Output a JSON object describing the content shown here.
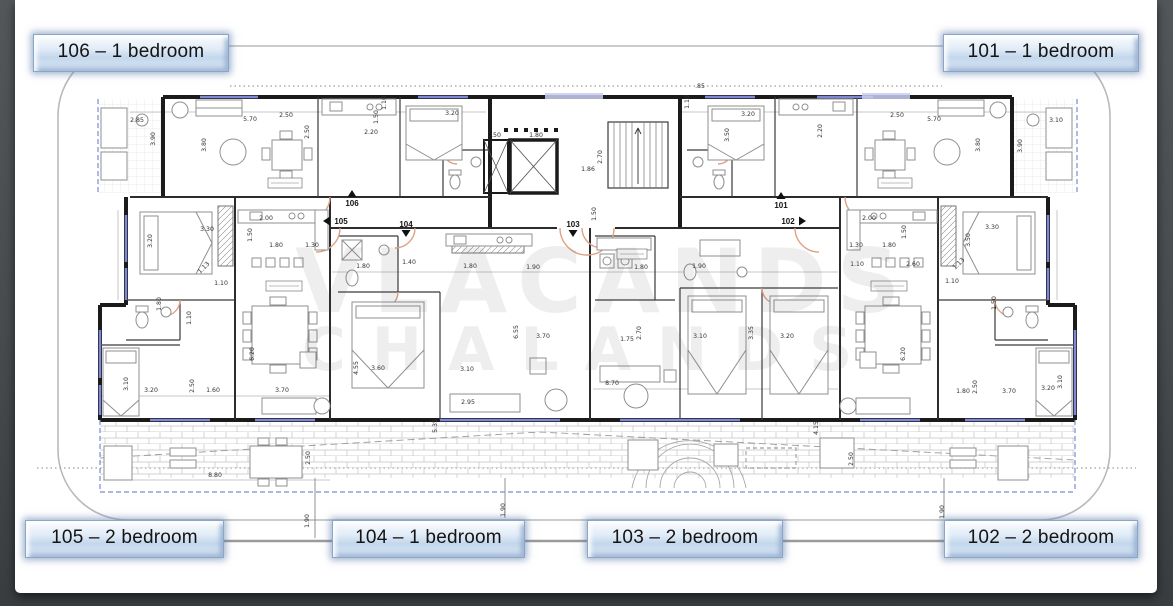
{
  "page": {
    "background_dark": "#474b4e",
    "sheet_color": "#ffffff"
  },
  "labels": [
    {
      "unit": "106",
      "text": "106 – 1 bedroom",
      "position": "top-left"
    },
    {
      "unit": "101",
      "text": "101 – 1 bedroom",
      "position": "top-right"
    },
    {
      "unit": "105",
      "text": "105 – 2 bedroom",
      "position": "bottom-left"
    },
    {
      "unit": "104",
      "text": "104 – 1 bedroom",
      "position": "bottom-center-left"
    },
    {
      "unit": "103",
      "text": "103 – 2 bedroom",
      "position": "bottom-center-right"
    },
    {
      "unit": "102",
      "text": "102 – 2 bedroom",
      "position": "bottom-right"
    }
  ],
  "watermark": {
    "line1_approx": "VLACANDS",
    "line2_approx": "CHALANDS"
  },
  "plan": {
    "unit_markers": [
      {
        "text": "106",
        "x": 352,
        "y": 206,
        "arrow": "up"
      },
      {
        "text": "105",
        "x": 341,
        "y": 224,
        "arrow": "left"
      },
      {
        "text": "104",
        "x": 406,
        "y": 227,
        "arrow": "down"
      },
      {
        "text": "103",
        "x": 573,
        "y": 227,
        "arrow": "down"
      },
      {
        "text": "101",
        "x": 781,
        "y": 208,
        "arrow": "up"
      },
      {
        "text": "102",
        "x": 788,
        "y": 224,
        "arrow": "right"
      }
    ],
    "dimensions": [
      [
        137,
        122,
        "2.85",
        0
      ],
      [
        250,
        121,
        "5.70",
        0
      ],
      [
        286,
        117,
        "2.50",
        0
      ],
      [
        371,
        134,
        "2.20",
        0
      ],
      [
        452,
        115,
        "3.20",
        0
      ],
      [
        155,
        139,
        "3.90",
        90
      ],
      [
        206,
        145,
        "3.80",
        90
      ],
      [
        309,
        132,
        "2.50",
        90
      ],
      [
        378,
        117,
        "1.50",
        90
      ],
      [
        386,
        103,
        "1.10",
        90
      ],
      [
        700,
        88,
        ".85",
        0
      ],
      [
        689,
        102,
        "1.10",
        90
      ],
      [
        536,
        137,
        "1.80",
        0
      ],
      [
        496,
        137,
        ".50",
        0
      ],
      [
        602,
        157,
        "2.70",
        90
      ],
      [
        588,
        171,
        "1.86",
        0
      ],
      [
        748,
        116,
        "3.20",
        0
      ],
      [
        897,
        117,
        "2.50",
        0
      ],
      [
        934,
        121,
        "5.70",
        0
      ],
      [
        1056,
        122,
        "3.10",
        0
      ],
      [
        729,
        135,
        "3.50",
        90
      ],
      [
        822,
        131,
        "2.20",
        90
      ],
      [
        980,
        145,
        "3.80",
        90
      ],
      [
        1022,
        146,
        "3.90",
        90
      ],
      [
        207,
        231,
        "3.30",
        0
      ],
      [
        152,
        241,
        "3.20",
        90
      ],
      [
        266,
        220,
        "2.00",
        0
      ],
      [
        252,
        235,
        "1.50",
        90
      ],
      [
        276,
        247,
        "1.80",
        0
      ],
      [
        312,
        247,
        "1.30",
        0
      ],
      [
        205,
        269,
        "1.13",
        45
      ],
      [
        221,
        285,
        "1.10",
        0
      ],
      [
        161,
        304,
        "1.80",
        90
      ],
      [
        191,
        318,
        "1.10",
        90
      ],
      [
        363,
        268,
        "1.80",
        0
      ],
      [
        409,
        264,
        "1.40",
        0
      ],
      [
        470,
        268,
        "1.80",
        0
      ],
      [
        533,
        269,
        "1.90",
        0
      ],
      [
        596,
        214,
        "1.50",
        90
      ],
      [
        641,
        269,
        "1.80",
        0
      ],
      [
        699,
        268,
        "1.90",
        0
      ],
      [
        869,
        220,
        "2.00",
        0
      ],
      [
        856,
        247,
        "1.30",
        0
      ],
      [
        889,
        247,
        "1.80",
        0
      ],
      [
        992,
        229,
        "3.30",
        0
      ],
      [
        970,
        240,
        "3.50",
        90
      ],
      [
        906,
        232,
        "1.50",
        90
      ],
      [
        913,
        266,
        "2.60",
        0
      ],
      [
        857,
        266,
        "1.10",
        0
      ],
      [
        960,
        265,
        "1.13",
        45
      ],
      [
        952,
        283,
        "1.10",
        0
      ],
      [
        996,
        303,
        "1.50",
        90
      ],
      [
        128,
        384,
        "3.10",
        90
      ],
      [
        151,
        392,
        "3.20",
        0
      ],
      [
        194,
        386,
        "2.50",
        90
      ],
      [
        213,
        392,
        "1.60",
        0
      ],
      [
        282,
        392,
        "3.70",
        0
      ],
      [
        254,
        354,
        "6.20",
        90
      ],
      [
        358,
        368,
        "4.55",
        90
      ],
      [
        378,
        370,
        "3.60",
        0
      ],
      [
        467,
        371,
        "3.10",
        0
      ],
      [
        518,
        332,
        "6.55",
        90
      ],
      [
        468,
        404,
        "2.95",
        0
      ],
      [
        437,
        426,
        "5.35",
        90
      ],
      [
        310,
        458,
        "2.50",
        90
      ],
      [
        215,
        477,
        "8.80",
        0
      ],
      [
        543,
        338,
        "3.70",
        0
      ],
      [
        627,
        341,
        "1.75",
        0
      ],
      [
        641,
        333,
        "2.70",
        90
      ],
      [
        700,
        338,
        "3.10",
        0
      ],
      [
        753,
        333,
        "3.35",
        90
      ],
      [
        787,
        338,
        "3.20",
        0
      ],
      [
        612,
        385,
        "8.70",
        0
      ],
      [
        818,
        428,
        "4.15",
        90
      ],
      [
        853,
        459,
        "2.50",
        90
      ],
      [
        905,
        354,
        "6.20",
        90
      ],
      [
        963,
        393,
        "1.80",
        0
      ],
      [
        977,
        387,
        "2.50",
        90
      ],
      [
        1009,
        393,
        "3.70",
        0
      ],
      [
        1048,
        390,
        "3.20",
        0
      ],
      [
        1062,
        382,
        "3.10",
        90
      ],
      [
        309,
        521,
        "1.90",
        90
      ],
      [
        505,
        510,
        "1.90",
        90
      ],
      [
        944,
        512,
        "1.90",
        90
      ]
    ]
  },
  "colors": {
    "wall": "#1b1b1b",
    "inner_wall": "#3a3a3a",
    "window_blue": "#7e88d5",
    "sill_lavender": "#c9cdf0",
    "door_arc": "#dfa183",
    "furniture": "#8f8f8f",
    "hatch": "#c4c4c4",
    "dim_text": "#333333",
    "connector_gray": "#9b9b9b",
    "plaque_fill": "#cfe0f2",
    "plaque_border": "#8aa5ca"
  }
}
